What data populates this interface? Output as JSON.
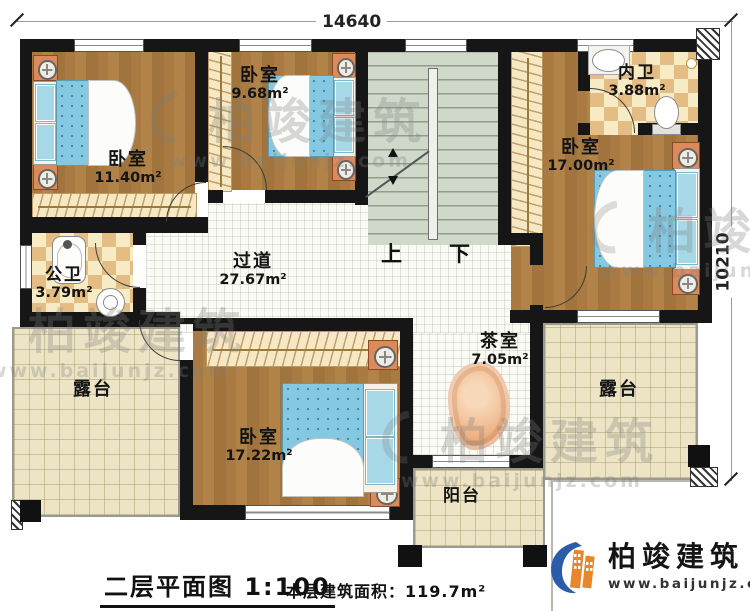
{
  "dimensions": {
    "top": "14640",
    "right": "10210"
  },
  "rooms": {
    "bedroom_tl": {
      "name": "卧室",
      "area": "11.40m²"
    },
    "bedroom_tm": {
      "name": "卧室",
      "area": "9.68m²"
    },
    "bedroom_r": {
      "name": "卧室",
      "area": "17.00m²"
    },
    "bedroom_b": {
      "name": "卧室",
      "area": "17.22m²"
    },
    "bath_public": {
      "name": "公卫",
      "area": "3.79m²"
    },
    "bath_inner": {
      "name": "内卫",
      "area": "3.88m²"
    },
    "hallway": {
      "name": "过道",
      "area": "27.67m²"
    },
    "tea_room": {
      "name": "茶室",
      "area": "7.05m²"
    },
    "terrace_left": {
      "name": "露台"
    },
    "terrace_right": {
      "name": "露台"
    },
    "balcony": {
      "name": "阳台"
    }
  },
  "stairs": {
    "up": "上",
    "down": "下"
  },
  "footer": {
    "title": "二层平面图",
    "scale": "1:100",
    "area_label": "本层建筑面积：",
    "area_value": "119.7m²"
  },
  "brand": {
    "name": "柏竣建筑",
    "url": "www.baijunjz.com"
  },
  "watermark": {
    "text": "柏竣建筑",
    "url": "www.baijunjz.com"
  },
  "colors": {
    "wall": "#161616",
    "wood": "#a97b42",
    "tile_dark": "#e4bd85",
    "tile_light": "#f7ebc6",
    "hall_floor": "#fbfbf6",
    "terrace_floor": "#ece4c5",
    "stair_floor": "#cfd8c9",
    "mattress_blue": "#84c8e1",
    "nightstand_orange": "#dd8a5b",
    "brand_blue": "#2a5caa",
    "brand_orange": "#e8862a"
  }
}
